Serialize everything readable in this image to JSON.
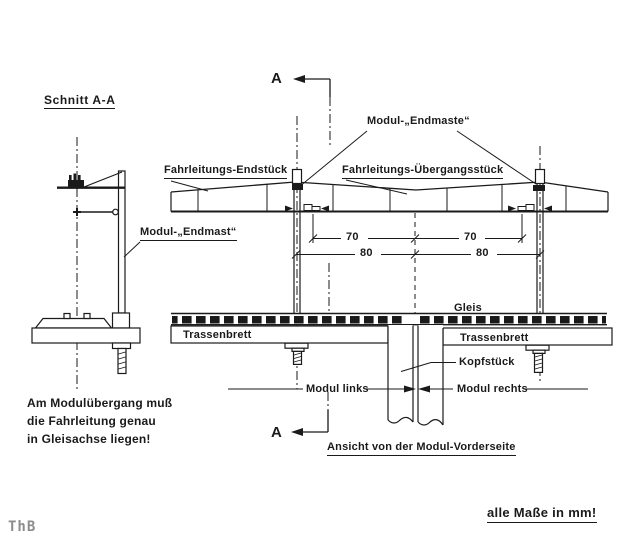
{
  "section_view": {
    "title": "Schnitt A-A",
    "mast_label": "Modul-„Endmast“",
    "note": "Am Modulübergang muß\ndie Fahrleitung genau\nin Gleisachse liegen!"
  },
  "front_view": {
    "caption": "Ansicht von der Modul-Vorderseite",
    "masts_label": "Modul-„Endmaste“",
    "catenary_end_label": "Fahrleitungs-Endstück",
    "catenary_transition_label": "Fahrleitungs-Übergangsstück",
    "track_label": "Gleis",
    "board_left_label": "Trassenbrett",
    "board_right_label": "Trassenbrett",
    "head_piece_label": "Kopfstück",
    "module_left_label": "Modul links",
    "module_right_label": "Modul rechts",
    "dimensions": {
      "contact_70_left": "70",
      "contact_70_right": "70",
      "mast_80_left": "80",
      "mast_80_right": "80"
    }
  },
  "section_cut": {
    "marker_top": "A",
    "marker_bottom": "A"
  },
  "footer": {
    "units_note": "alle Maße in mm!",
    "signature": "ThB"
  },
  "colors": {
    "ink": "#1a1a1a",
    "paper": "#ffffff",
    "signature_gray": "#8c8c8c"
  }
}
